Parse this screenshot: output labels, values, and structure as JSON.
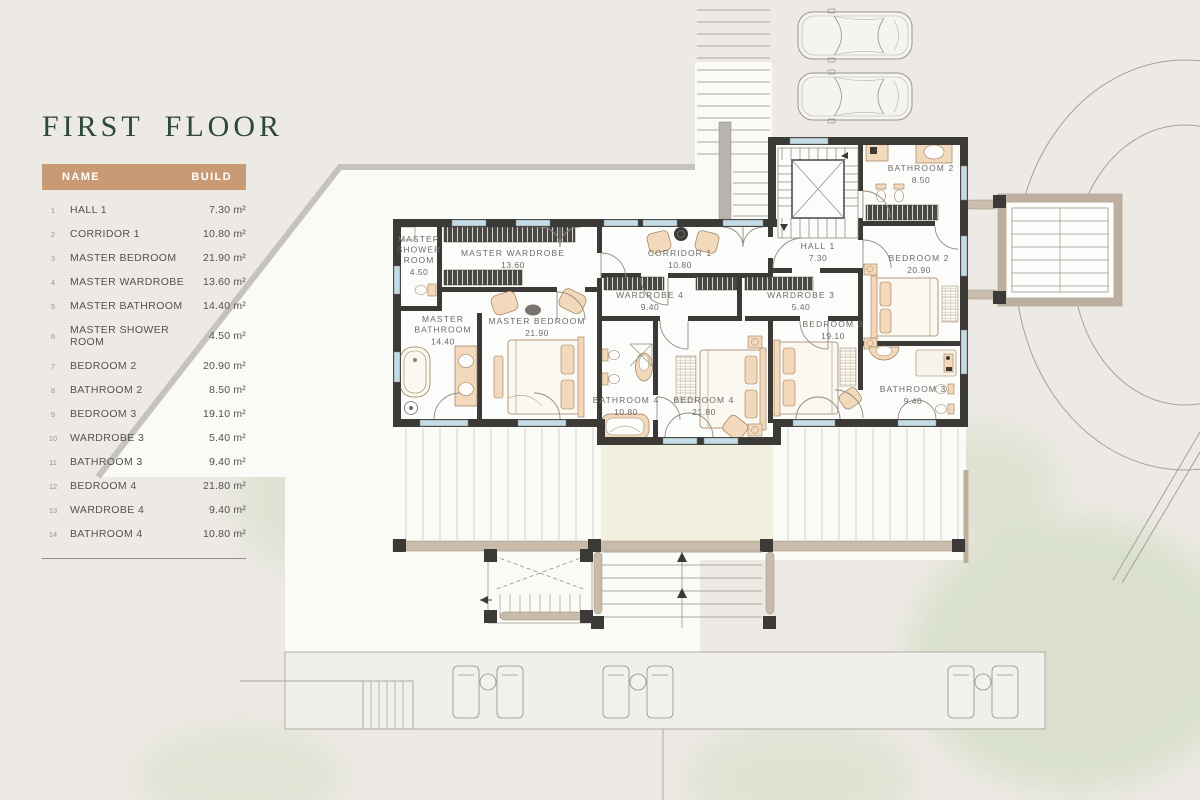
{
  "panel": {
    "title": "FIRST FLOOR",
    "table": {
      "headers": {
        "name": "NAME",
        "build": "BUILD"
      },
      "rows": [
        {
          "num": "1",
          "name": "HALL 1",
          "area": "7.30 m²"
        },
        {
          "num": "2",
          "name": "CORRIDOR 1",
          "area": "10.80 m²"
        },
        {
          "num": "3",
          "name": "MASTER BEDROOM",
          "area": "21.90 m²"
        },
        {
          "num": "4",
          "name": "MASTER WARDROBE",
          "area": "13.60 m²"
        },
        {
          "num": "5",
          "name": "MASTER BATHROOM",
          "area": "14.40 m²"
        },
        {
          "num": "6",
          "name": "MASTER SHOWER ROOM",
          "area": "4.50 m²"
        },
        {
          "num": "7",
          "name": "BEDROOM 2",
          "area": "20.90 m²"
        },
        {
          "num": "8",
          "name": "BATHROOM 2",
          "area": "8.50 m²"
        },
        {
          "num": "9",
          "name": "BEDROOM 3",
          "area": "19.10 m²"
        },
        {
          "num": "10",
          "name": "WARDROBE 3",
          "area": "5.40 m²"
        },
        {
          "num": "11",
          "name": "BATHROOM 3",
          "area": "9.40 m²"
        },
        {
          "num": "12",
          "name": "BEDROOM 4",
          "area": "21.80 m²"
        },
        {
          "num": "13",
          "name": "WARDROBE 4",
          "area": "9.40 m²"
        },
        {
          "num": "14",
          "name": "BATHROOM 4",
          "area": "10.80 m²"
        }
      ]
    }
  },
  "plan": {
    "rooms": [
      {
        "id": "master-shower-room",
        "lines": [
          "MASTER",
          "SHOWER",
          "ROOM"
        ],
        "area": "4.50",
        "x": 419,
        "y": 242
      },
      {
        "id": "master-wardrobe",
        "lines": [
          "MASTER WARDROBE"
        ],
        "area": "13.60",
        "x": 513,
        "y": 256
      },
      {
        "id": "master-bathroom",
        "lines": [
          "MASTER",
          "BATHROOM"
        ],
        "area": "14.40",
        "x": 443,
        "y": 322
      },
      {
        "id": "master-bedroom",
        "lines": [
          "MASTER BEDROOM"
        ],
        "area": "21.90",
        "x": 537,
        "y": 324
      },
      {
        "id": "corridor-1",
        "lines": [
          "CORRIDOR 1"
        ],
        "area": "10.80",
        "x": 680,
        "y": 256
      },
      {
        "id": "wardrobe-4",
        "lines": [
          "WARDROBE 4"
        ],
        "area": "9.40",
        "x": 650,
        "y": 298
      },
      {
        "id": "wardrobe-3",
        "lines": [
          "WARDROBE 3"
        ],
        "area": "5.40",
        "x": 801,
        "y": 298
      },
      {
        "id": "bathroom-4",
        "lines": [
          "BATHROOM 4"
        ],
        "area": "10.80",
        "x": 626,
        "y": 403
      },
      {
        "id": "bedroom-4",
        "lines": [
          "BEDROOM 4"
        ],
        "area": "21.80",
        "x": 704,
        "y": 403
      },
      {
        "id": "bedroom-3",
        "lines": [
          "BEDROOM 3"
        ],
        "area": "19.10",
        "x": 833,
        "y": 327
      },
      {
        "id": "bedroom-2",
        "lines": [
          "BEDROOM 2"
        ],
        "area": "20.90",
        "x": 919,
        "y": 261
      },
      {
        "id": "bathroom-2",
        "lines": [
          "BATHROOM 2"
        ],
        "area": "8.50",
        "x": 921,
        "y": 171
      },
      {
        "id": "bathroom-3",
        "lines": [
          "BATHROOM 3"
        ],
        "area": "9.40",
        "x": 913,
        "y": 392
      },
      {
        "id": "hall-1",
        "lines": [
          "HALL 1"
        ],
        "area": "7.30",
        "x": 818,
        "y": 249
      }
    ],
    "colors": {
      "background": "#EDEAE5",
      "title_green": "#2E4839",
      "table_header_tan": "#C89B76",
      "wall": "#3B3A37",
      "window_blue": "#C3DCE6",
      "furniture_tan": "#F2D9BC",
      "deck_beam_tan": "#C6B9A8",
      "terrace_cream": "#F2EFDE",
      "greenery": "#D3DCC4",
      "room_floor": "#FCFCFA"
    }
  }
}
